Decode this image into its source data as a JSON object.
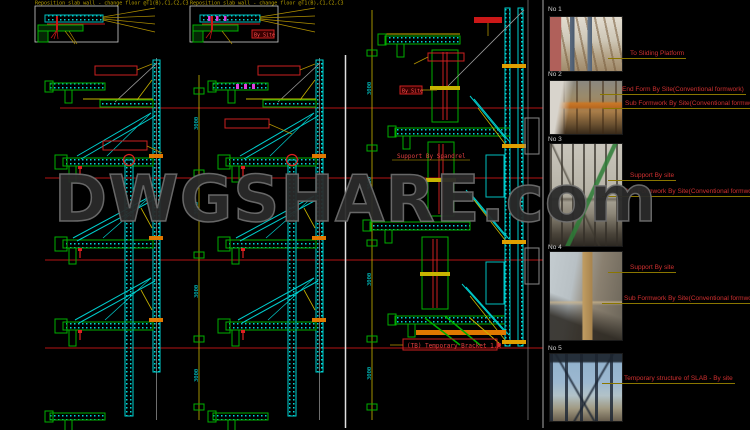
{
  "colors": {
    "background": "#000000",
    "cad_cyan": "#00d0d0",
    "cad_green": "#00b000",
    "cad_red": "#cc2020",
    "cad_yellow": "#c8b400",
    "cad_orange": "#e07800",
    "cad_magenta": "#e040e0",
    "annotation_red": "#d03030",
    "leader_yellow": "#8a7600",
    "watermark_gray": "#2a2a2a"
  },
  "watermark": {
    "text": "DWGSHARE.com"
  },
  "top_details": {
    "box1_title": "Reposition slab wall - change floor @T1(B),C1,C2,C3",
    "box2_title": "Reposition slab wall - change floor @T1(B),C1,C2,C3",
    "by_site_label": "By Site"
  },
  "dimensions": {
    "v3000": "3000"
  },
  "middle_section": {
    "by_site_label": "By Site",
    "support_note": "Support By Spandrel",
    "bracket_note": "(TB) Temporary Bracket 1.X"
  },
  "photos": [
    {
      "label": "No 1",
      "annotations": [
        "To Sliding Platform"
      ]
    },
    {
      "label": "No 2",
      "annotations": [
        "End Form By Site(Conventional formwork)",
        "Sub Formwork By Site(Conventional formwork)"
      ]
    },
    {
      "label": "No 3",
      "annotations": [
        "Support By site",
        "Sub Formwork By Site(Conventional formwork)"
      ]
    },
    {
      "label": "No 4",
      "annotations": [
        "Support By site",
        "Sub Formwork By Site(Conventional formwork)"
      ]
    },
    {
      "label": "No 5",
      "annotations": [
        "Temporary structure of SLAB - By site"
      ]
    }
  ]
}
